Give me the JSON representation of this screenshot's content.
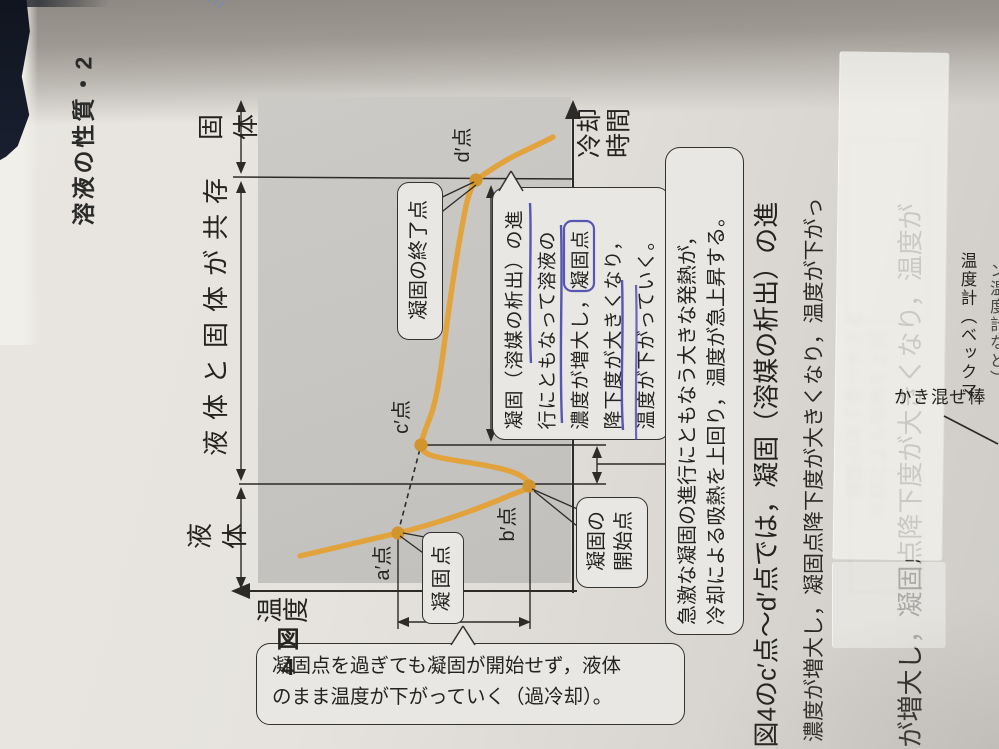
{
  "page": {
    "header": "溶液の性質・2",
    "stamp": "TH"
  },
  "figure4": {
    "caption": "図\n4",
    "temp_axis_label": "温度",
    "time_axis_label": "冷却\n時間",
    "regions": {
      "liquid": "液体",
      "coexist": "液体と固体が共存",
      "solid": "固体"
    },
    "points": {
      "a": "a′点",
      "b": "b′点",
      "c": "c′点",
      "d": "d′点"
    },
    "callouts": {
      "freezing_point": "凝固点",
      "start_of_freezing": "凝固の\n開始点",
      "end_of_freezing": "凝固の終了点"
    },
    "notes": {
      "supercooling": [
        "凝固点を過ぎても凝固が開始せず，液体",
        "のまま温度が下がっていく（過冷却）。"
      ],
      "rapid_heat": [
        "急激な凝固の進行にともなう大きな発熱が，",
        "冷却による吸熱を上回り，温度が急上昇する。"
      ],
      "progress_blue_underlined": [
        "凝固（溶媒の析出）の進",
        "行にともなって溶液の",
        "濃度が増大し，凝固点",
        "降下度が大きくなり，",
        "温度が下がっていく。"
      ]
    }
  },
  "body_text": {
    "line1": "図4のc′点～d′点では，凝固（溶媒の析出）の進",
    "line2": "濃度が増大し，凝固点降下度が大きくなり，温度が下がっ",
    "line3_under_tape": "が増大し，凝固点降下度が大きくなり，温度が"
  },
  "next_figure": {
    "stirrer": "かき混ぜ棒",
    "thermometer": "温度計（ベックマ",
    "thermometer2": "ン温度計など）"
  },
  "ghosts": {
    "g1": "凝固点降下度が大きく",
    "g2": "冷却による吸熱を上回"
  },
  "colors": {
    "curve_orange": "#e2a23c",
    "dot_orange": "#d2942c",
    "pen_blue": "#3c3caa",
    "ink": "#242320",
    "plot_gray": "#c7c5c1",
    "paper": "#e6e3de",
    "edge_navy": "#161c2b"
  },
  "chart_data": {
    "type": "line",
    "title": "冷却曲線（溶液の凝固・過冷却）",
    "xlabel": "冷却時間",
    "ylabel": "温度",
    "regions": [
      "液体",
      "液体と固体が共存",
      "固体"
    ],
    "series": [
      {
        "name": "冷却曲線",
        "points_qualitative": [
          {
            "label": "開始",
            "time": 0.0,
            "temp": 0.95
          },
          {
            "label": "a′点(凝固点)",
            "time": 0.12,
            "temp": 0.62
          },
          {
            "label": "b′点(凝固の開始点・過冷却の底)",
            "time": 0.24,
            "temp": 0.18
          },
          {
            "label": "c′点",
            "time": 0.33,
            "temp": 0.56
          },
          {
            "label": "d′点(凝固の終了点)",
            "time": 0.88,
            "temp": 0.44
          },
          {
            "label": "終端",
            "time": 1.0,
            "temp": 0.2
          }
        ]
      }
    ],
    "annotations": [
      "凝固点",
      "凝固の開始点",
      "凝固の終了点",
      "過冷却",
      "a′点とc′点を結ぶ破線（凝固点の外挿）"
    ]
  }
}
